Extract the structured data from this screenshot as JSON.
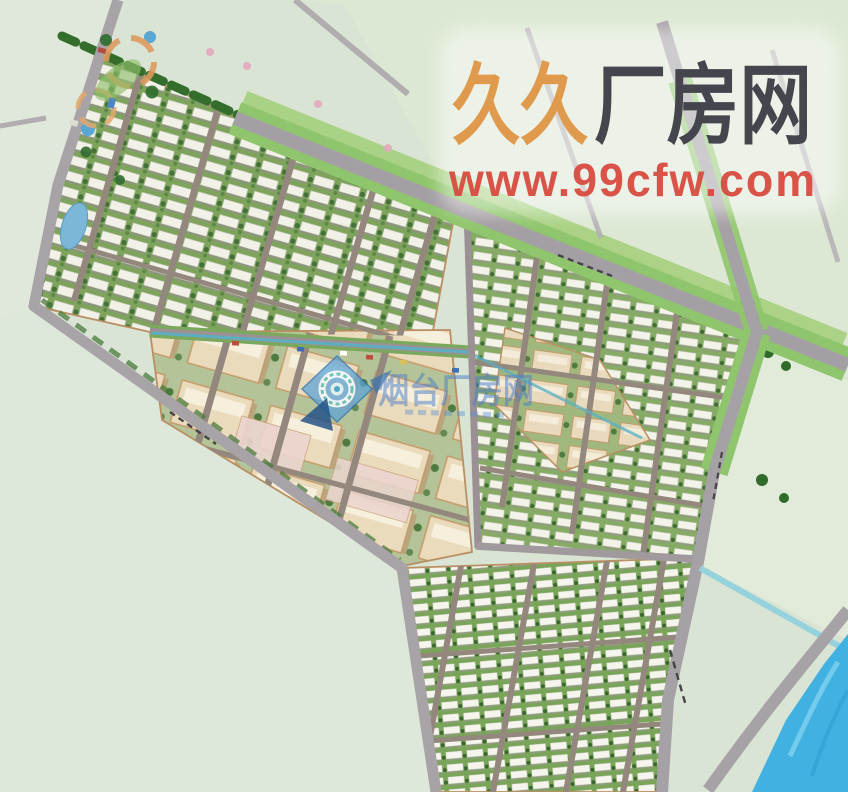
{
  "watermarks": {
    "top_right": {
      "brand_first": "久久",
      "brand_rest": "厂房网",
      "url": "www.99cfw.com"
    },
    "center": {
      "brand": "烟台厂房网"
    }
  },
  "palette": {
    "bg": "#d9e4d4",
    "field": "#dde7da",
    "road": "#a49fa4",
    "road_minor": "#a7a3a7",
    "verge": "#8fc56c",
    "belt": "#a8d182",
    "tree": "#2f6429",
    "block_edge": "#b98f63",
    "river": "#41b1e1",
    "pond": "#5aa6d4",
    "canal": "#96d2dc",
    "stream": "#58b0c4",
    "wm_orange": "#e09a4e",
    "wm_dark": "#45454d",
    "wm_red": "#d84b41",
    "wm_blue": "#4a7cc9"
  }
}
